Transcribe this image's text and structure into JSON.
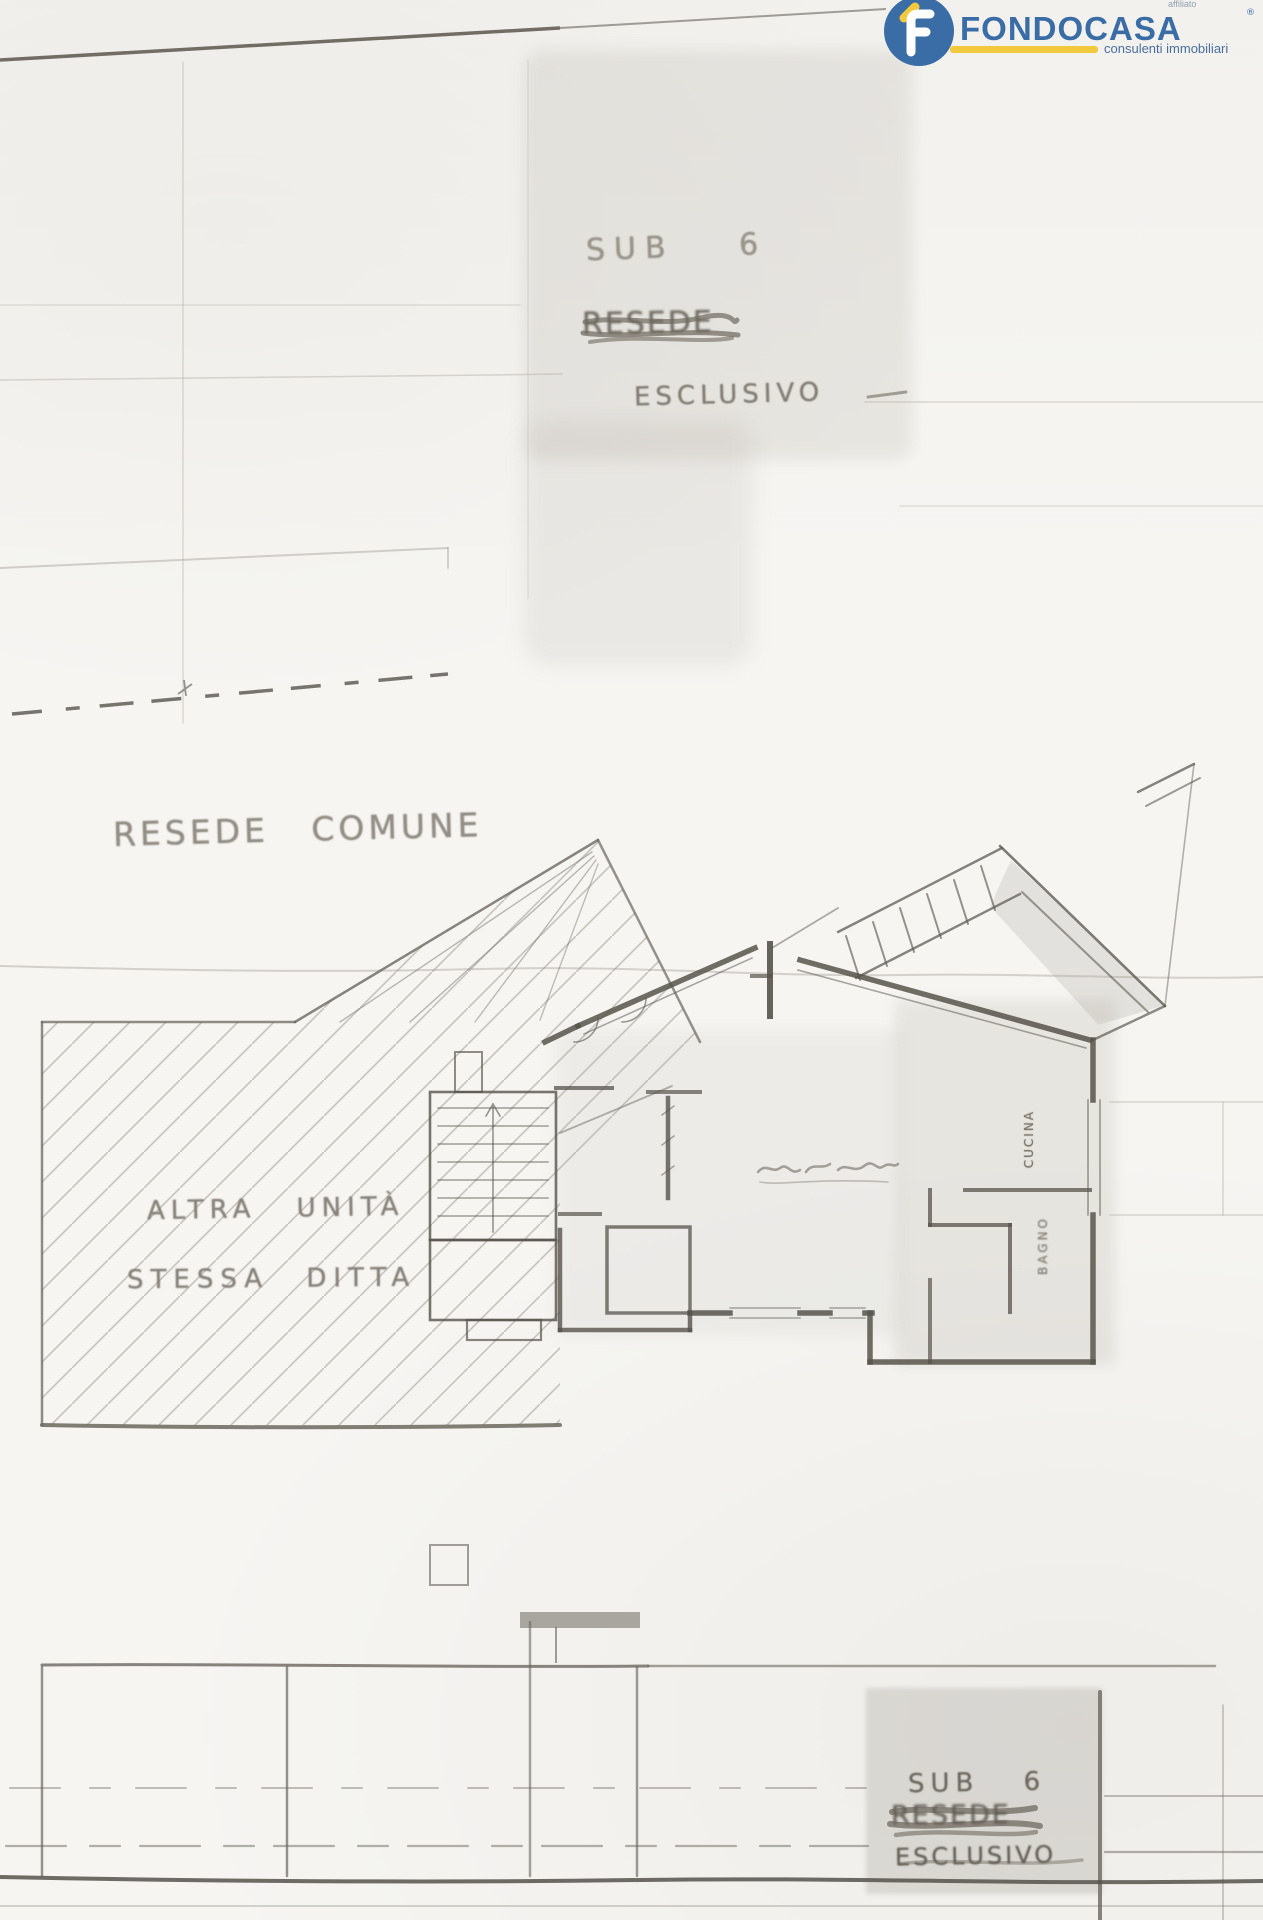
{
  "logo": {
    "brand": "FONDOCASA",
    "registered": "®",
    "affiliate_label": "affiliato",
    "tagline": "consulenti immobiliari",
    "brand_color": "#3a6ca6",
    "accent_color": "#f2c93c"
  },
  "annotations": {
    "top": {
      "sub_label": "SUB 6",
      "scrawled_word": "RESEDE",
      "exclusive_label": "ESCLUSIVO"
    },
    "courtyard_label": "RESEDE COMUNE",
    "other_unit_line1": "ALTRA UNITÀ",
    "other_unit_line2": "STESSA DITTA",
    "rooms": {
      "kitchen": "CUCINA",
      "bathroom": "BAGNO"
    },
    "bottom": {
      "sub_label": "SUB 6",
      "scrawled_word": "RESEDE",
      "exclusive_label": "ESCLUSIVO"
    }
  },
  "palette": {
    "paper": "#f6f5f2",
    "pencil_faint": "#a9a49c",
    "pencil_mid": "#6b675f",
    "pencil_dark": "#55524b",
    "handwriting": "#8a857c",
    "scan_shade": "rgba(125,119,108,0.14)"
  }
}
